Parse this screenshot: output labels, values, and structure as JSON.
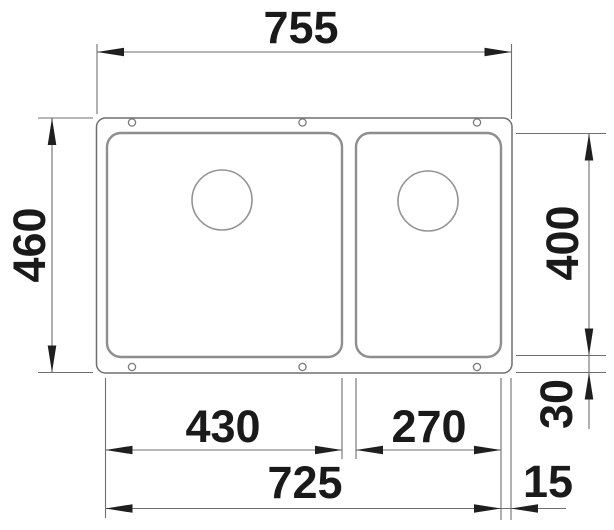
{
  "drawing": {
    "type": "technical-dimension-drawing",
    "subject": "double-bowl undermount sink, top view",
    "colors": {
      "background": "#ffffff",
      "outline": "#6f6f6f",
      "bowl_line": "#8e8e8e",
      "drain_line": "#949494",
      "arrow": "#1f1f1f",
      "text": "#1a1a1a"
    }
  },
  "dimensions": {
    "overall_width": "755",
    "overall_depth": "460",
    "bowl_depth": "400",
    "rear_rim_offset": "30",
    "left_bowl_width": "430",
    "right_bowl_width": "270",
    "inner_width": "725",
    "side_rim_offset": "15"
  }
}
